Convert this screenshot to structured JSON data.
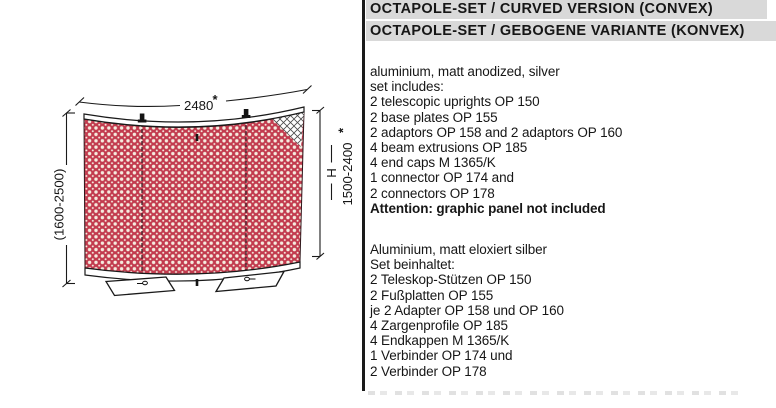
{
  "header": {
    "line1": "OCTAPOLE-SET / CURVED VERSION (CONVEX)",
    "line2": "OCTAPOLE-SET / GEBOGENE VARIANTE (KONVEX)"
  },
  "description_en": {
    "lines": [
      "aluminium, matt anodized, silver",
      "set includes:",
      "2 telescopic uprights OP 150",
      "2 base plates OP 155",
      "2 adaptors OP 158 and 2 adaptors OP 160",
      "4 beam extrusions OP 185",
      "4 end caps M 1365/K",
      "1 connector OP 174 and",
      "2 connectors OP 178"
    ],
    "attention": "Attention: graphic panel not included"
  },
  "description_de": {
    "lines": [
      "Aluminium, matt eloxiert silber",
      "Set beinhaltet:",
      "2 Teleskop-Stützen OP 150",
      "2 Fußplatten OP 155",
      "je 2 Adapter OP 158 und OP 160",
      "4 Zargenprofile OP 185",
      "4 Endkappen M 1365/K",
      "1 Verbinder OP 174 und",
      "2 Verbinder OP 178"
    ]
  },
  "diagram": {
    "top_width": "2480",
    "asterisk": "*",
    "left_height_range": "(1600-2500)",
    "height_symbol": "H",
    "right_height_range": "1500-2400",
    "panel_red": "#c23b4e",
    "pattern_dot": "#f5ecdf",
    "header_bar_gray": "#d9d9d9"
  }
}
